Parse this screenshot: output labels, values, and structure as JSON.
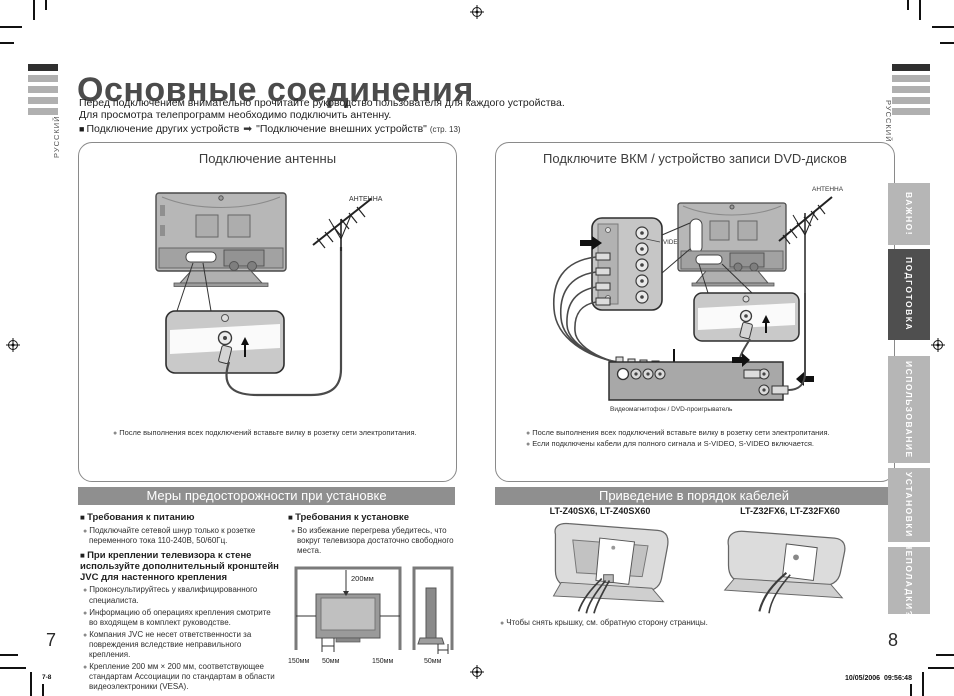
{
  "colors": {
    "section_header_bg": "#8f8f8f",
    "tab_inactive_bg": "#b6b6b6",
    "tab_active_bg": "#4f4f4f",
    "title_color": "#4b4b4b"
  },
  "page": {
    "title": "Основные соединения",
    "intro_line1": "Перед подключением внимательно прочитайте руководство пользователя для каждого устройства.",
    "intro_line2": "Для просмотра телепрограмм необходимо подключить антенну.",
    "other_devices_label": "Подключение других устройств",
    "other_devices_arrow": "➡",
    "other_devices_ref": "\"Подключение внешних устройств\"",
    "other_devices_page": "(стр. 13)",
    "language_left": "РУССКИЙ",
    "language_right": "РУССКИЙ",
    "left_page_number": "7",
    "right_page_number": "8",
    "footer_left": "7-8",
    "footer_date": "10/05/2006",
    "footer_time": "09:56:48"
  },
  "antenna_panel": {
    "title": "Подключение антенны",
    "antenna_label": "АНТЕННА",
    "note": "После выполнения всех подключений вставьте вилку в розетку сети электропитания."
  },
  "vcr_panel": {
    "title": "Подключите ВКМ / устройство записи DVD-дисков",
    "antenna_label": "АНТЕННА",
    "video_input_label": "VIDEO-1",
    "device_label": "Видеомагнитофон / DVD-проигрыватель",
    "note1": "После выполнения всех подключений вставьте вилку в розетку сети электропитания.",
    "note2": "Если подключены кабели для полного сигнала и S-VIDEO, S-VIDEO включается."
  },
  "precautions": {
    "header": "Меры предосторожности при установке",
    "power_heading": "Требования к питанию",
    "power_bullet": "Подключайте сетевой шнур только к розетке переменного тока 110-240В, 50/60Гц.",
    "mount_heading": "При креплении телевизора к стене используйте дополнительный кронштейн JVC для настенного крепления",
    "mount_bullets": [
      "Проконсультируйтесь у квалифицированного специалиста.",
      "Информацию об операциях крепления смотрите во входящем в комплект руководстве.",
      "Компания JVC не несет ответственности за повреждения вследствие неправильного крепления.",
      "Крепление 200 мм × 200 мм, соответствующее стандартам Ассоциации по стандартам в области видеоэлектроники (VESA)."
    ],
    "install_heading": "Требования к установке",
    "install_bullet": "Во избежание перегрева убедитесь, что вокруг телевизора достаточно свободного места.",
    "clearance": {
      "top": "200мм",
      "side_left": "150мм",
      "bottom_left": "50мм",
      "side_right": "150мм",
      "side_view": "50мм"
    }
  },
  "cables": {
    "header": "Приведение в порядок кабелей",
    "model_left": "LT-Z40SX6, LT-Z40SX60",
    "model_right": "LT-Z32FX6, LT-Z32FX60",
    "note": "Чтобы снять крышку, см. обратную сторону страницы."
  },
  "sidebar": {
    "tabs": [
      {
        "label": "ВАЖНО!",
        "active": false
      },
      {
        "label": "ПОДГОТОВКА",
        "active": true
      },
      {
        "label": "ИСПОЛЬЗОВАНИЕ",
        "active": false
      },
      {
        "label": "УСТАНОВКИ",
        "active": false
      },
      {
        "label": "НЕПОЛАДКИ?",
        "active": false
      }
    ]
  }
}
